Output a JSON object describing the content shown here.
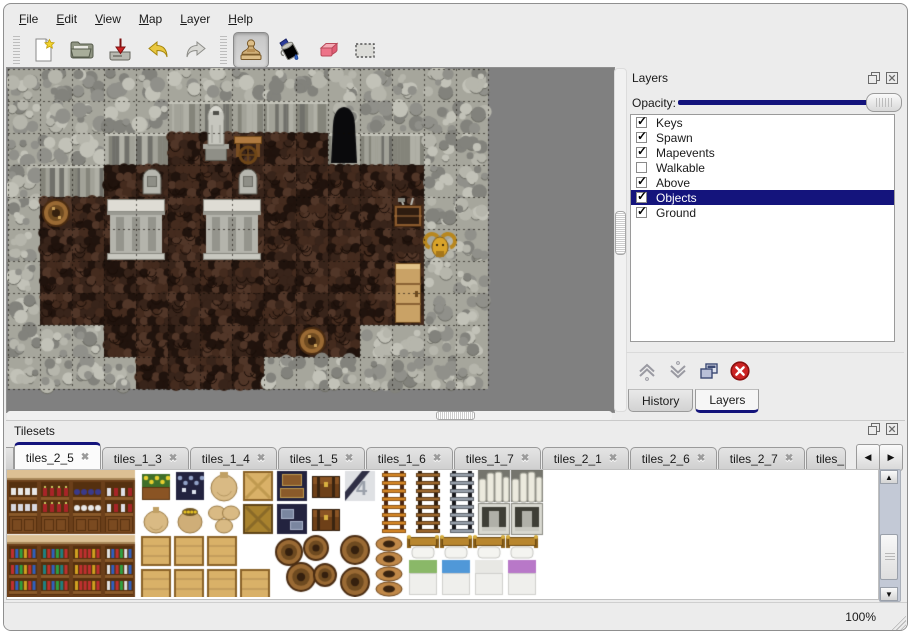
{
  "icons": {
    "close_tab": "✖",
    "check": "✓",
    "up": "▲",
    "down": "▼",
    "left": "◀",
    "right": "▶"
  },
  "window": {
    "background": "#ececec",
    "accent": "#14147c"
  },
  "menu": {
    "items": [
      {
        "label": "File"
      },
      {
        "label": "Edit"
      },
      {
        "label": "View"
      },
      {
        "label": "Map"
      },
      {
        "label": "Layer"
      },
      {
        "label": "Help"
      }
    ]
  },
  "toolbar": {
    "buttons": [
      {
        "name": "new"
      },
      {
        "name": "open"
      },
      {
        "name": "save"
      },
      {
        "name": "undo"
      },
      {
        "name": "redo"
      }
    ],
    "tools": [
      {
        "name": "stamp",
        "active": true
      },
      {
        "name": "fill",
        "active": false
      },
      {
        "name": "eraser",
        "active": false
      },
      {
        "name": "select",
        "active": false
      }
    ]
  },
  "layers_panel": {
    "title": "Layers",
    "opacity_label": "Opacity:",
    "opacity_percent": 100,
    "layers": [
      {
        "name": "Keys",
        "checked": true,
        "selected": false
      },
      {
        "name": "Spawn",
        "checked": true,
        "selected": false
      },
      {
        "name": "Mapevents",
        "checked": true,
        "selected": false
      },
      {
        "name": "Walkable",
        "checked": false,
        "selected": false
      },
      {
        "name": "Above",
        "checked": true,
        "selected": false
      },
      {
        "name": "Objects",
        "checked": true,
        "selected": true
      },
      {
        "name": "Ground",
        "checked": true,
        "selected": false
      }
    ],
    "buttons": [
      {
        "name": "raise-layer"
      },
      {
        "name": "lower-layer"
      },
      {
        "name": "duplicate-layer"
      },
      {
        "name": "delete-layer"
      }
    ]
  },
  "dock_tabs": [
    {
      "label": "History",
      "active": false
    },
    {
      "label": "Layers",
      "active": true
    }
  ],
  "tilesets_panel": {
    "title": "Tilesets",
    "tabs": [
      {
        "label": "tiles_2_5",
        "active": true
      },
      {
        "label": "tiles_1_3",
        "active": false
      },
      {
        "label": "tiles_1_4",
        "active": false
      },
      {
        "label": "tiles_1_5",
        "active": false
      },
      {
        "label": "tiles_1_6",
        "active": false
      },
      {
        "label": "tiles_1_7",
        "active": false
      },
      {
        "label": "tiles_2_1",
        "active": false
      },
      {
        "label": "tiles_2_6",
        "active": false
      },
      {
        "label": "tiles_2_7",
        "active": false
      },
      {
        "label": "tiles_",
        "active": false,
        "truncated": true
      }
    ]
  },
  "status_bar": {
    "zoom_level": "100%"
  },
  "map": {
    "tile_size": 32,
    "cols": 15,
    "rows": 10,
    "grid": [
      "RRRRRRRRRRRRRRR",
      "RRRRRRRRRRRRRRR",
      "RRRRRFFFFFRRRRR",
      "RRRFFFFFFFFFFRR",
      "RFFFFFFFFFFFFRR",
      "RFFFFFFFFFFFFRR",
      "RFFFFFFFFFFFFRR",
      "RFFFFFFFFFFFFRR",
      "RRRFFFFFFFFRRRR",
      "RRRRFFFFRRRRRRR"
    ],
    "objects": [
      {
        "type": "statue",
        "col": 6,
        "row": 1
      },
      {
        "type": "table",
        "col": 7,
        "row": 2
      },
      {
        "type": "cave-entrance",
        "col": 10,
        "row": 1
      },
      {
        "type": "gravestone",
        "col": 4,
        "row": 3
      },
      {
        "type": "gravestone",
        "col": 7,
        "row": 3
      },
      {
        "type": "tomb",
        "col": 3,
        "row": 4
      },
      {
        "type": "tomb",
        "col": 6,
        "row": 4
      },
      {
        "type": "barrel",
        "col": 1,
        "row": 4
      },
      {
        "type": "open-crate",
        "col": 12,
        "row": 4
      },
      {
        "type": "ram-head",
        "col": 13,
        "row": 5
      },
      {
        "type": "cabinet",
        "col": 12,
        "row": 6
      },
      {
        "type": "barrel",
        "col": 9,
        "row": 8
      }
    ],
    "palette": {
      "rock": "#a6a69c",
      "cliff": "#9a9a90",
      "floor": "#2b1a12",
      "void": "#808080"
    }
  },
  "tileset_preview": {
    "background": "#ffffff",
    "bed_colors": [
      "#8ab868",
      "#5098d8",
      "#e8e8e4",
      "#b878c8"
    ],
    "sprites": [
      {
        "t": "shelf",
        "x": 0,
        "y": 0,
        "v": "dishes"
      },
      {
        "t": "shelf",
        "x": 32,
        "y": 0,
        "v": "wine"
      },
      {
        "t": "shelf",
        "x": 64,
        "y": 0,
        "v": "bluepots"
      },
      {
        "t": "shelf",
        "x": 96,
        "y": 0,
        "v": "wine2"
      },
      {
        "t": "shelf2",
        "x": 0,
        "y": 65,
        "v": 0
      },
      {
        "t": "shelf2",
        "x": 32,
        "y": 65,
        "v": 1
      },
      {
        "t": "shelf2",
        "x": 64,
        "y": 65,
        "v": 2
      },
      {
        "t": "shelf2",
        "x": 96,
        "y": 65,
        "v": 3
      },
      {
        "t": "planter",
        "x": 133,
        "y": 0,
        "v": "yellow"
      },
      {
        "t": "planter",
        "x": 167,
        "y": 0,
        "v": "blue"
      },
      {
        "t": "sack_big",
        "x": 201,
        "y": 0
      },
      {
        "t": "crate_x",
        "x": 235,
        "y": 0,
        "v": "light"
      },
      {
        "t": "navy_crates",
        "x": 269,
        "y": 0,
        "v": "a"
      },
      {
        "t": "chest",
        "x": 303,
        "y": 0
      },
      {
        "t": "plank4",
        "x": 337,
        "y": 0
      },
      {
        "t": "ladder",
        "x": 371,
        "y": 0,
        "v": "orange"
      },
      {
        "t": "ladder",
        "x": 405,
        "y": 0,
        "v": "brown"
      },
      {
        "t": "ladder",
        "x": 439,
        "y": 0,
        "v": "gray"
      },
      {
        "t": "arch",
        "x": 471,
        "y": 0
      },
      {
        "t": "arch",
        "x": 504,
        "y": 0
      },
      {
        "t": "sack",
        "x": 133,
        "y": 33
      },
      {
        "t": "sack_gold",
        "x": 167,
        "y": 33
      },
      {
        "t": "sack_pile",
        "x": 201,
        "y": 33
      },
      {
        "t": "crate_x",
        "x": 235,
        "y": 33,
        "v": "dark"
      },
      {
        "t": "navy_crates",
        "x": 269,
        "y": 33,
        "v": "b"
      },
      {
        "t": "chest",
        "x": 303,
        "y": 33
      },
      {
        "t": "stone_door",
        "x": 471,
        "y": 33
      },
      {
        "t": "stone_door",
        "x": 504,
        "y": 33
      },
      {
        "t": "counter",
        "x": 133,
        "y": 65
      },
      {
        "t": "counter",
        "x": 166,
        "y": 65
      },
      {
        "t": "counter",
        "x": 199,
        "y": 65
      },
      {
        "t": "counter",
        "x": 133,
        "y": 98
      },
      {
        "t": "counter",
        "x": 166,
        "y": 98
      },
      {
        "t": "counter",
        "x": 199,
        "y": 98
      },
      {
        "t": "counter",
        "x": 232,
        "y": 98
      },
      {
        "t": "barrel_pile",
        "x": 266,
        "y": 65
      },
      {
        "t": "barrel_top",
        "x": 332,
        "y": 65
      },
      {
        "t": "barrel_top",
        "x": 332,
        "y": 97
      },
      {
        "t": "pots",
        "x": 366,
        "y": 65
      },
      {
        "t": "bed",
        "x": 400,
        "y": 65,
        "v": 0
      },
      {
        "t": "bed",
        "x": 433,
        "y": 65,
        "v": 1
      },
      {
        "t": "bed",
        "x": 466,
        "y": 65,
        "v": 2
      },
      {
        "t": "bed",
        "x": 499,
        "y": 65,
        "v": 3
      }
    ]
  }
}
